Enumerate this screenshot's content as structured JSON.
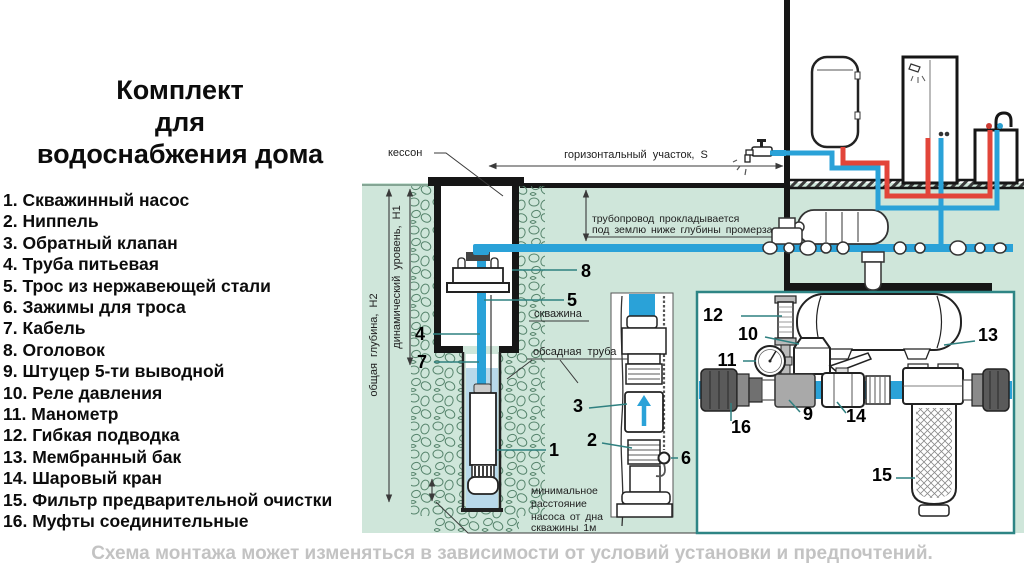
{
  "title": {
    "line1": "Комплект",
    "line2": "для",
    "line3": "водоснабжения дома"
  },
  "legend": {
    "items": [
      "1. Скважинный насос",
      "2. Ниппель",
      "3. Обратный клапан",
      "4. Труба питьевая",
      "5. Трос из нержавеющей стали",
      "6. Зажимы для троса",
      "7. Кабель",
      "8. Оголовок",
      "9. Штуцер 5-ти выводной",
      "10. Реле давления",
      "11. Манометр",
      "12. Гибкая подводка",
      "13. Мембранный бак",
      "14. Шаровый кран",
      "15. Фильтр предварительной очистки",
      "16. Муфты соединительные"
    ]
  },
  "diagram": {
    "labels": {
      "kesson": "кессон",
      "horizontal_section": "горизонтальный участок, S",
      "pipeline_note1": "трубопровод прокладывается",
      "pipeline_note2": "под землю ниже глубины промерзания",
      "well": "скважина",
      "casing": "обсадная труба",
      "total_depth": "общая глубина, Н2",
      "dynamic_level": "динамический уровень, Н1",
      "min_dist1": "минимальное",
      "min_dist2": "расстояние",
      "min_dist3": "насоса от дна",
      "min_dist4": "скважины 1м"
    },
    "callouts": {
      "c1": "1",
      "c2": "2",
      "c3": "3",
      "c4": "4",
      "c5": "5",
      "c6": "6",
      "c7": "7",
      "c8": "8",
      "c9": "9",
      "c10": "10",
      "c11": "11",
      "c12": "12",
      "c13": "13",
      "c14": "14",
      "c15": "15",
      "c16": "16"
    }
  },
  "footer": {
    "note": "Схема монтажа может изменяться в зависимости от условий установки и предпочтений."
  },
  "colors": {
    "ground_green": "#cfe6da",
    "stone_outline": "#55836b",
    "pipe_blue": "#2aa2d8",
    "hot_red": "#e2453a",
    "well_water": "#b9d9ea",
    "panel_border": "#2e8585",
    "leader_teal": "#2f8080",
    "footer_gray": "#c3c3c3"
  }
}
